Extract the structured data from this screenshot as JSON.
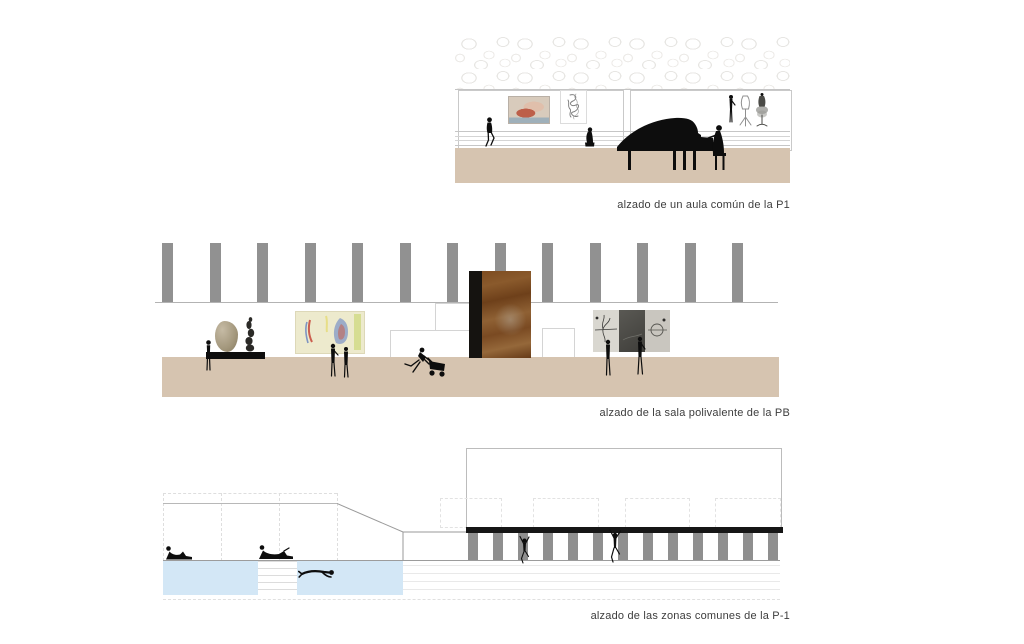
{
  "colors": {
    "floor": "#d6c4b0",
    "column_gray": "#919191",
    "pool_blue": "#d3e7f6",
    "beam_black": "#161616",
    "caption_text": "#3d3d3d",
    "silhouette": "#0d0d0d"
  },
  "elevations": {
    "aula": {
      "caption": "alzado de un aula común de la P1",
      "items": [
        "stone texture band",
        "two wall panels",
        "reclining-figure painting",
        "gesture sketch",
        "two seated figures",
        "grand piano with pianist",
        "mannequin group"
      ]
    },
    "sala": {
      "caption": "alzado de la sala polivalente de la PB",
      "column_count": 13,
      "items": [
        "ceiling columns",
        "sculpture table with two sculptures",
        "abstract colour painting with two viewers",
        "corten steel panel",
        "figure pushing cart",
        "grey triptych with two viewers"
      ]
    },
    "zonas": {
      "caption": "alzado de las zonas comunes de la P-1",
      "baluster_count": 13,
      "items": [
        "two pools with swimmer",
        "two sunbathers",
        "ramp",
        "black beam with balusters",
        "two climbing figures"
      ]
    }
  }
}
